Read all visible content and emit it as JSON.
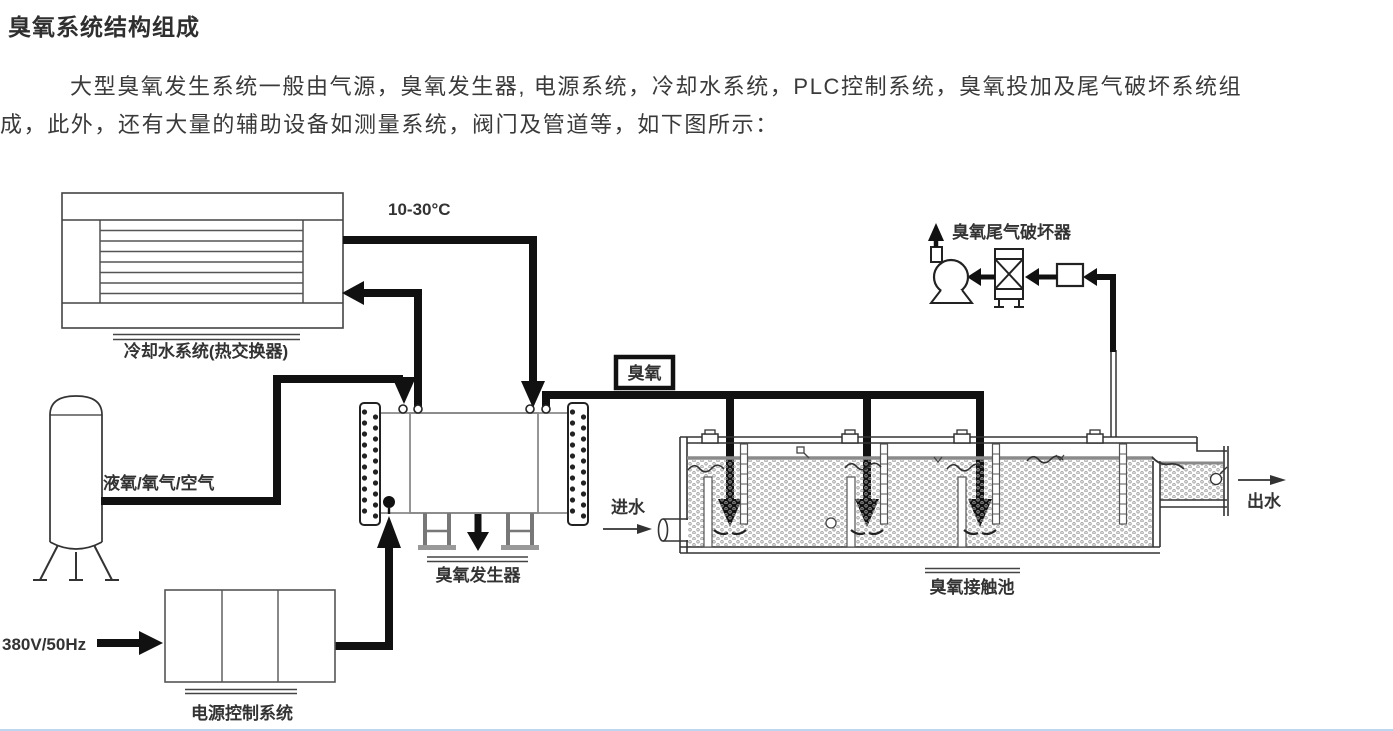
{
  "document": {
    "title": "臭氧系统结构组成",
    "body_line1": "大型臭氧发生系统一般由气源，臭氧发生器, 电源系统，冷却水系统，PLC控制系统，臭氧投加及尾气破坏系统组",
    "body_line2": "成，此外，还有大量的辅助设备如测量系统，阀门及管道等，如下图所示："
  },
  "diagram": {
    "cooling_system_label": "冷却水系统(热交换器)",
    "temperature_label": "10-30°C",
    "gas_source_label": "液氧/氧气/空气",
    "generator_label": "臭氧发生器",
    "power_cabinet_label": "电源控制系统",
    "power_input_label": "380V/50Hz",
    "ozone_tag": "臭氧",
    "tail_gas_label": "臭氧尾气破坏器",
    "water_in_label": "进水",
    "water_out_label": "出水",
    "contact_tank_label": "臭氧接触池",
    "colors": {
      "pipe": "#111111",
      "outline": "#333333",
      "equipment_gray": "#888888",
      "water_dot": "#9b9b9b"
    }
  }
}
